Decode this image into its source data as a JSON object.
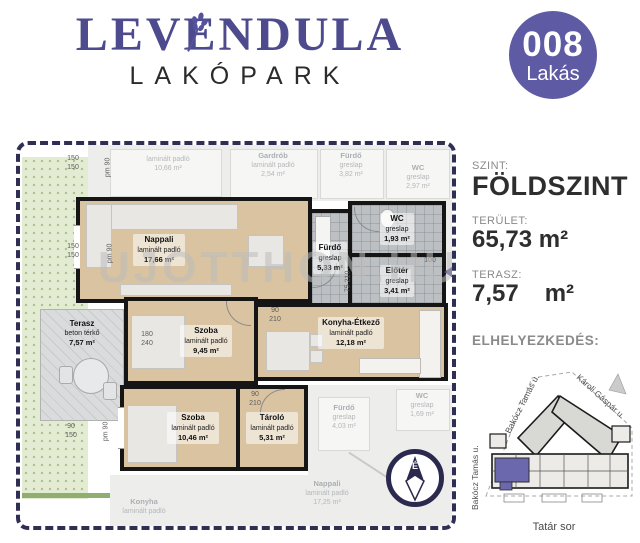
{
  "header": {
    "logo_title": "LEVENDULA",
    "logo_subtitle": "LAKÓPARK",
    "badge_number": "008",
    "badge_label": "Lakás"
  },
  "plan": {
    "watermark": "UJOTTHON.HU",
    "compass": "É",
    "rooms": {
      "nappali": {
        "name": "Nappali",
        "floor": "laminált padló",
        "area": "17,66 m²"
      },
      "terasz": {
        "name": "Terasz",
        "floor": "beton térkő",
        "area": "7,57 m²"
      },
      "szoba1": {
        "name": "Szoba",
        "floor": "laminált padló",
        "area": "9,45 m²"
      },
      "szoba2": {
        "name": "Szoba",
        "floor": "laminált padló",
        "area": "10,46 m²"
      },
      "tarolo": {
        "name": "Tároló",
        "floor": "laminált padló",
        "area": "5,31 m²"
      },
      "konyha": {
        "name": "Konyha-Étkező",
        "floor": "laminált padló",
        "area": "12,18 m²"
      },
      "furdo": {
        "name": "Fürdő",
        "floor": "greslap",
        "area": "5,33 m²"
      },
      "wc": {
        "name": "WC",
        "floor": "greslap",
        "area": "1,93 m²"
      },
      "eloter": {
        "name": "Előtér",
        "floor": "greslap",
        "area": "3,41 m²"
      }
    },
    "neighbors": {
      "top1": {
        "floor": "laminált padló",
        "area": "10,66 m²"
      },
      "top2": {
        "name": "Gardrób",
        "floor": "laminált padló",
        "area": "2,54 m²"
      },
      "top3": {
        "name": "Fürdő",
        "floor": "greslap",
        "area": "3,82 m²"
      },
      "top4": {
        "name": "WC",
        "floor": "greslap",
        "area": "2,97 m²"
      },
      "bot1": {
        "name": "Fürdő",
        "floor": "greslap",
        "area": "4,03 m²"
      },
      "bot2": {
        "name": "WC",
        "floor": "greslap",
        "area": "1,69 m²"
      },
      "bot3": {
        "name": "Nappali",
        "floor": "laminált padló",
        "area": "17,25 m²"
      },
      "bot4": {
        "name": "Konyha",
        "floor": "laminált padló"
      }
    },
    "dims": {
      "tl1": "150",
      "tl2": "150",
      "tl3": "pm 90",
      "ml1": "150",
      "ml2": "150",
      "ml3": "pm 90",
      "bl1": "90",
      "bl2": "150",
      "bl3": "pm 90",
      "sz1a": "180",
      "sz1b": "240",
      "sz1c": "90",
      "sz1d": "210",
      "ta1": "90",
      "ta2": "210",
      "fu1": "75",
      "fu2": "210",
      "el1": "100"
    }
  },
  "sidebar": {
    "szint_label": "SZINT:",
    "szint_value": "FÖLDSZINT",
    "terulet_label": "TERÜLET:",
    "terulet_value": "65,73 m²",
    "terasz_label": "TERASZ:",
    "terasz_value": "7,57",
    "terasz_unit": "m²",
    "location_label": "ELHELYEZKEDÉS:",
    "map_caption": "Tatár sor",
    "map_streets": {
      "left_diag": "Bakócz Tamás u.",
      "right_diag": "Károli Gáspár u.",
      "left_vert": "Bakócz Tamás u."
    }
  },
  "colors": {
    "brand_purple": "#4d4a8e",
    "badge_purple": "#5e5aa4",
    "plan_border_navy": "#2f2e55",
    "laminate_tan": "#d9c3a0",
    "tile_gray": "#bcc0c3",
    "highlight_unit_purple": "#6c68ad"
  }
}
